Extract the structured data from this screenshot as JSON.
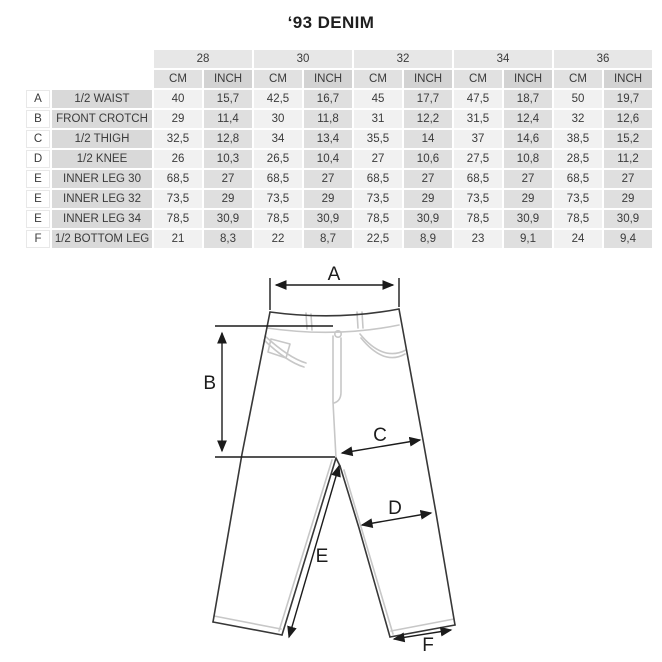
{
  "title": "‘93 DENIM",
  "table": {
    "sizes": [
      "28",
      "30",
      "32",
      "34",
      "36"
    ],
    "unit_headers": [
      "CM",
      "INCH"
    ],
    "rows": [
      {
        "letter": "A",
        "label": "1/2 WAIST",
        "values": [
          "40",
          "15,7",
          "42,5",
          "16,7",
          "45",
          "17,7",
          "47,5",
          "18,7",
          "50",
          "19,7"
        ]
      },
      {
        "letter": "B",
        "label": "FRONT CROTCH",
        "values": [
          "29",
          "11,4",
          "30",
          "11,8",
          "31",
          "12,2",
          "31,5",
          "12,4",
          "32",
          "12,6"
        ]
      },
      {
        "letter": "C",
        "label": "1/2 THIGH",
        "values": [
          "32,5",
          "12,8",
          "34",
          "13,4",
          "35,5",
          "14",
          "37",
          "14,6",
          "38,5",
          "15,2"
        ]
      },
      {
        "letter": "D",
        "label": "1/2 KNEE",
        "values": [
          "26",
          "10,3",
          "26,5",
          "10,4",
          "27",
          "10,6",
          "27,5",
          "10,8",
          "28,5",
          "11,2"
        ]
      },
      {
        "letter": "E",
        "label": "INNER LEG 30",
        "values": [
          "68,5",
          "27",
          "68,5",
          "27",
          "68,5",
          "27",
          "68,5",
          "27",
          "68,5",
          "27"
        ]
      },
      {
        "letter": "E",
        "label": "INNER LEG 32",
        "values": [
          "73,5",
          "29",
          "73,5",
          "29",
          "73,5",
          "29",
          "73,5",
          "29",
          "73,5",
          "29"
        ]
      },
      {
        "letter": "E",
        "label": "INNER LEG 34",
        "values": [
          "78,5",
          "30,9",
          "78,5",
          "30,9",
          "78,5",
          "30,9",
          "78,5",
          "30,9",
          "78,5",
          "30,9"
        ]
      },
      {
        "letter": "F",
        "label": "1/2 BOTTOM LEG",
        "values": [
          "21",
          "8,3",
          "22",
          "8,7",
          "22,5",
          "8,9",
          "23",
          "9,1",
          "24",
          "9,4"
        ]
      }
    ]
  },
  "diagram": {
    "labels": {
      "waist": "A",
      "front_crotch": "B",
      "thigh": "C",
      "knee": "D",
      "inner_leg": "E",
      "bottom_leg": "F"
    }
  },
  "colors": {
    "size_header_bg": "#e7e7e7",
    "cm_header_bg": "#e1e1e1",
    "inch_header_bg": "#d3d3d3",
    "cm_cell_bg": "#f1f1f1",
    "inch_cell_bg": "#dfdfdf",
    "row_label_bg": "#d9d9d9",
    "jeans_outline": "#383838",
    "jeans_stitch": "#c7c7c7",
    "arrow_color": "#1b1b1b"
  }
}
